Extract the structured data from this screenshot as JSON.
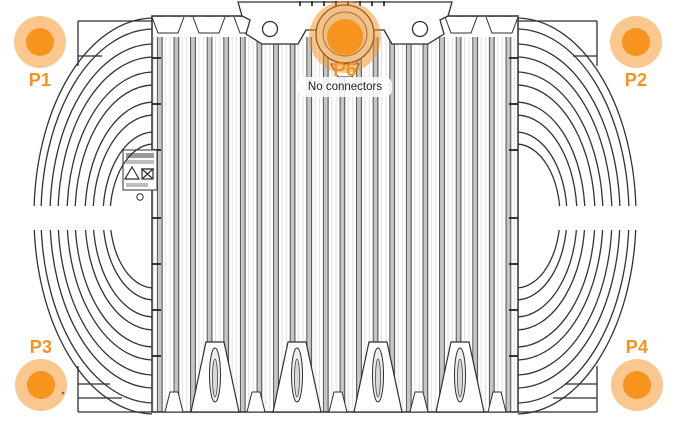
{
  "view": {
    "description": "Radio unit rear line-drawing with connector point overlay",
    "width_px": 675,
    "height_px": 429
  },
  "markers": [
    {
      "id": "P1",
      "label": "P1",
      "placement": "top-left",
      "label_placement": "below"
    },
    {
      "id": "P2",
      "label": "P2",
      "placement": "top-right",
      "label_placement": "below"
    },
    {
      "id": "P3",
      "label": "P3",
      "placement": "bottom-left",
      "label_placement": "above"
    },
    {
      "id": "P4",
      "label": "P4",
      "placement": "bottom-right",
      "label_placement": "above"
    },
    {
      "id": "P6",
      "label": "P6",
      "placement": "top-center",
      "label_placement": "below",
      "state": "selected"
    }
  ],
  "p6_tooltip": {
    "text": "No connectors"
  },
  "colors": {
    "marker_halo": "rgba(246,146,30,0.5)",
    "marker_dot": "#F7941E",
    "marker_label_text": "#F6921E",
    "tooltip_bg": "rgba(255,255,255,0.85)",
    "tooltip_text": "#1C1C1C",
    "drawing_line": "#2F2F2F",
    "fin_shade": "#C6C6C6"
  }
}
